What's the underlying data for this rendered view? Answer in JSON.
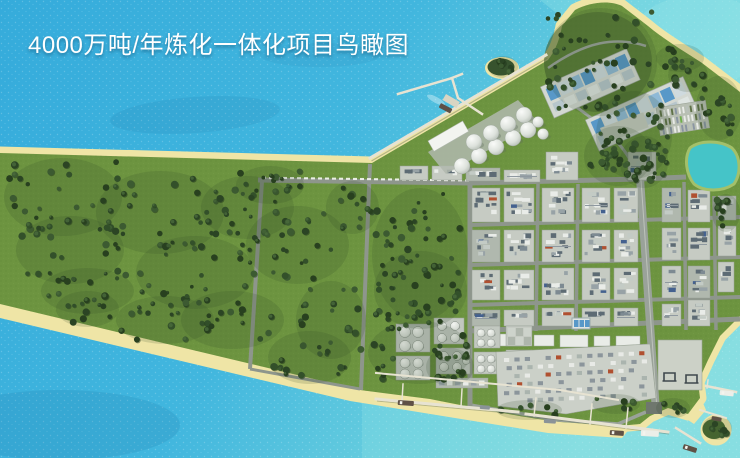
{
  "title": {
    "text": "4000万吨/年炼化一体化项目鸟瞰图"
  },
  "colors": {
    "water_deep": "#35abdb",
    "water_mid": "#41b6de",
    "water_light": "#85dde0",
    "water_shadow": "#16699a",
    "land_green": "#6d9440",
    "forest_dark": "#2b4424",
    "forest_mid": "#3c5a31",
    "sand": "#efe5a6",
    "plot_light": "#c6cbc3",
    "plot_mid": "#b0b8ae",
    "unit_dark": "#5d6b74",
    "unit_white": "#e9ece8",
    "accent_red": "#b05030",
    "accent_blue": "#44618f",
    "road": "#8e968c",
    "road_dark": "#6f776e",
    "pool_blue": "#5898c8",
    "lake": "#45c4c8",
    "pier": "#e7e3d2",
    "tank_white": "#d9ddd7",
    "hull_dark": "#5f5146",
    "title_text": "#ffffff"
  }
}
